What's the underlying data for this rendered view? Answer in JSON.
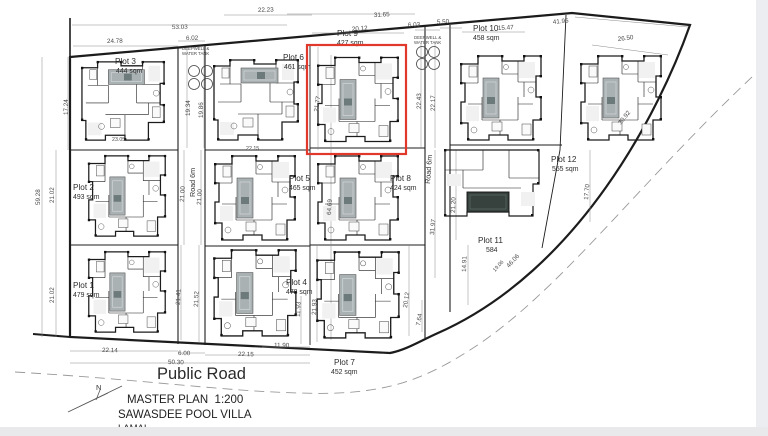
{
  "titles": {
    "public_road": "Public Road",
    "master_plan": "MASTER PLAN  1:200",
    "project": "SAWASDEE POOL VILLA",
    "location": "LAMAI",
    "north": "N"
  },
  "deepwell": {
    "line1": "DEEPWELL &",
    "line2": "WATER TANK"
  },
  "selection": {
    "highlighted_plot": "Plot 9"
  },
  "colors": {
    "boundary": "#1c1c1c",
    "red_box": "#e0392c",
    "pool": "#a9b1b3",
    "pool_dark": "#37423e",
    "dimension_text": "#4a4a4a",
    "background": "#ffffff",
    "edge_strip": "#ebedf0"
  },
  "roads": [
    {
      "label": "Road 6m",
      "x": 195,
      "y": 197,
      "r": -90
    },
    {
      "label": "Road 6m",
      "x": 430,
      "y": 184,
      "r": -86
    }
  ],
  "plots": [
    {
      "name": "Plot 1",
      "area": "479 sqm",
      "x": 73,
      "y": 288,
      "ax": 73,
      "ay": 297
    },
    {
      "name": "Plot 2",
      "area": "493 sqm",
      "x": 73,
      "y": 190,
      "ax": 73,
      "ay": 199
    },
    {
      "name": "Plot 3",
      "area": "444 sqm",
      "x": 115,
      "y": 64,
      "ax": 116,
      "ay": 73
    },
    {
      "name": "Plot 4",
      "area": "478 sqm",
      "x": 286,
      "y": 285,
      "ax": 286,
      "ay": 294
    },
    {
      "name": "Plot 5",
      "area": "465 sqm",
      "x": 289,
      "y": 181,
      "ax": 289,
      "ay": 190
    },
    {
      "name": "Plot 6",
      "area": "461 sqm",
      "x": 283,
      "y": 60,
      "ax": 284,
      "ay": 69
    },
    {
      "name": "Plot 7",
      "area": "452 sqm",
      "x": 334,
      "y": 365,
      "ax": 331,
      "ay": 374
    },
    {
      "name": "Plot 8",
      "area": "424 sqm",
      "x": 390,
      "y": 181,
      "ax": 390,
      "ay": 190
    },
    {
      "name": "Plot 9",
      "area": "427 sqm",
      "x": 337,
      "y": 36,
      "ax": 337,
      "ay": 45
    },
    {
      "name": "Plot 10",
      "area": "458 sqm",
      "x": 473,
      "y": 31,
      "ax": 473,
      "ay": 40
    },
    {
      "name": "Plot 11",
      "area": "584",
      "x": 478,
      "y": 243,
      "ax": 486,
      "ay": 252
    },
    {
      "name": "Plot 12",
      "area": "555 sqm",
      "x": 551,
      "y": 162,
      "ax": 552,
      "ay": 171
    }
  ],
  "dimensions": [
    {
      "t": "53.03",
      "x": 172,
      "y": 29,
      "r": -1
    },
    {
      "t": "24.78",
      "x": 107,
      "y": 43,
      "r": -1
    },
    {
      "t": "6.02",
      "x": 186,
      "y": 40,
      "r": -1
    },
    {
      "t": "22.23",
      "x": 258,
      "y": 12,
      "r": -2
    },
    {
      "t": "31.65",
      "x": 374,
      "y": 17,
      "r": -3
    },
    {
      "t": "20.12",
      "x": 352,
      "y": 31,
      "r": -4
    },
    {
      "t": "6.03",
      "x": 408,
      "y": 27,
      "r": -3
    },
    {
      "t": "5.50",
      "x": 437,
      "y": 24,
      "r": -3
    },
    {
      "t": "15.47",
      "x": 498,
      "y": 30,
      "r": -3
    },
    {
      "t": "41.95",
      "x": 553,
      "y": 24,
      "r": -6
    },
    {
      "t": "26.50",
      "x": 618,
      "y": 41,
      "r": -7
    },
    {
      "t": "59.28",
      "x": 40,
      "y": 205,
      "r": -90
    },
    {
      "t": "17.24",
      "x": 68,
      "y": 115,
      "r": -90
    },
    {
      "t": "21.02",
      "x": 54,
      "y": 203,
      "r": -90
    },
    {
      "t": "21.02",
      "x": 54,
      "y": 303,
      "r": -90
    },
    {
      "t": "19.34",
      "x": 190,
      "y": 116,
      "r": -90
    },
    {
      "t": "19.86",
      "x": 203,
      "y": 118,
      "r": -90
    },
    {
      "t": "21.00",
      "x": 184,
      "y": 202,
      "r": -87
    },
    {
      "t": "21.00",
      "x": 201,
      "y": 205,
      "r": -87
    },
    {
      "t": "21.41",
      "x": 180,
      "y": 305,
      "r": -88
    },
    {
      "t": "21.52",
      "x": 198,
      "y": 307,
      "r": -88
    },
    {
      "t": "21.77",
      "x": 318,
      "y": 112,
      "r": -82
    },
    {
      "t": "64.69",
      "x": 331,
      "y": 215,
      "r": -87
    },
    {
      "t": "22.43",
      "x": 421,
      "y": 109,
      "r": -90
    },
    {
      "t": "22.17",
      "x": 435,
      "y": 111,
      "r": -90
    },
    {
      "t": "31.97",
      "x": 434,
      "y": 235,
      "r": -85
    },
    {
      "t": "21.20",
      "x": 455,
      "y": 213,
      "r": -88
    },
    {
      "t": "20.12",
      "x": 407,
      "y": 308,
      "r": -82
    },
    {
      "t": "7.64",
      "x": 420,
      "y": 326,
      "r": -80
    },
    {
      "t": "21.93",
      "x": 316,
      "y": 315,
      "r": -88
    },
    {
      "t": "11.93",
      "x": 300,
      "y": 317,
      "r": -88
    },
    {
      "t": "14.91",
      "x": 466,
      "y": 272,
      "r": -88
    },
    {
      "t": "17.70",
      "x": 588,
      "y": 200,
      "r": -85
    },
    {
      "t": "30.92",
      "x": 621,
      "y": 125,
      "r": -52
    },
    {
      "t": "46.06",
      "x": 509,
      "y": 268,
      "r": -48
    },
    {
      "t": "19.06",
      "x": 495,
      "y": 272,
      "r": -48,
      "s": true
    },
    {
      "t": "22.14",
      "x": 102,
      "y": 352,
      "r": 1
    },
    {
      "t": "6.00",
      "x": 178,
      "y": 355,
      "r": 1
    },
    {
      "t": "50.30",
      "x": 168,
      "y": 364,
      "r": 1
    },
    {
      "t": "22.15",
      "x": 238,
      "y": 356,
      "r": 1
    },
    {
      "t": "11.90",
      "x": 274,
      "y": 347,
      "r": 1
    },
    {
      "t": "23.05",
      "x": 112,
      "y": 141,
      "r": 0,
      "s": true
    },
    {
      "t": "22.15",
      "x": 246,
      "y": 150,
      "r": 0,
      "s": true
    }
  ]
}
